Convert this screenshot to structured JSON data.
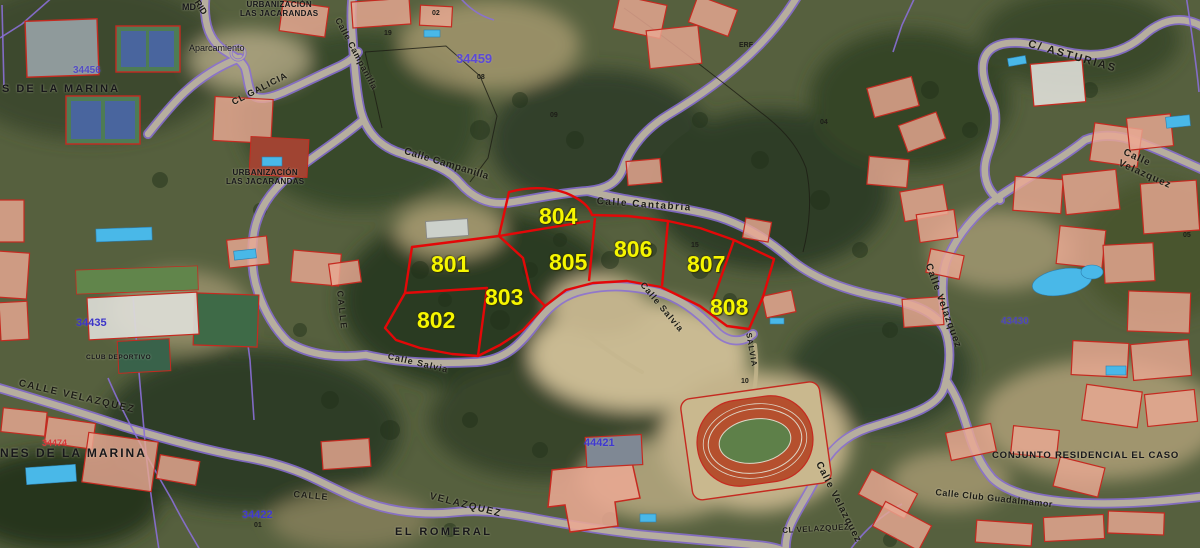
{
  "map": {
    "parcel_overlay": {
      "boundary_color": "#e30808",
      "label_color": "#f6f600",
      "plots": [
        {
          "number": "801"
        },
        {
          "number": "802"
        },
        {
          "number": "803"
        },
        {
          "number": "804"
        },
        {
          "number": "805"
        },
        {
          "number": "806"
        },
        {
          "number": "807"
        },
        {
          "number": "808"
        }
      ]
    },
    "zone_labels": [
      {
        "number": "34459",
        "color": "#5b49d6"
      },
      {
        "number": "34456",
        "color": "#4a40cc"
      },
      {
        "number": "34435",
        "color": "#3c34c8"
      },
      {
        "number": "34422",
        "color": "#3f38d0"
      },
      {
        "number": "44421",
        "color": "#3f38d0"
      },
      {
        "number": "43430",
        "color": "#4a40cc"
      },
      {
        "number": "34474",
        "color": "#d83838"
      }
    ],
    "street_labels": [
      {
        "text": "C/ ASTURIAS"
      },
      {
        "text": "Calle Velazquez"
      },
      {
        "text": "Calle Velazquez"
      },
      {
        "text": "Calle Velazquez"
      },
      {
        "text": "CL VELAZQUEZ"
      },
      {
        "text": "CALLE VELAZQUEZ"
      },
      {
        "text": "VELAZQUEZ"
      },
      {
        "text": "CL GALICIA"
      },
      {
        "text": "Calle Campanilla"
      },
      {
        "text": "Calle Campanilla"
      },
      {
        "text": "Calle Cantabria"
      },
      {
        "text": "Calle Salvia"
      },
      {
        "text": "Calle Salvia"
      },
      {
        "text": "SALVIA"
      },
      {
        "text": "CALLE"
      },
      {
        "text": "CALLE"
      },
      {
        "text": "RID"
      },
      {
        "text": "Calle Club Guadalmamor"
      }
    ],
    "place_labels": [
      {
        "text": "URBANIZACIÓN\nLAS JACARANDAS"
      },
      {
        "text": "URBANIZACIÓN\nLAS JACARANDAS"
      },
      {
        "text": "S DE LA MARINA"
      },
      {
        "text": "NES DE LA MARINA"
      },
      {
        "text": "EL ROMERAL"
      },
      {
        "text": "CONJUNTO RESIDENCIAL EL CASO"
      },
      {
        "text": "Aparcamiento"
      },
      {
        "text": "MD"
      },
      {
        "text": "CLUB DEPORTIVO"
      }
    ],
    "lot_numbers": [
      {
        "text": "02"
      },
      {
        "text": "19"
      },
      {
        "text": "08"
      },
      {
        "text": "09"
      },
      {
        "text": "04"
      },
      {
        "text": "05"
      },
      {
        "text": "15"
      },
      {
        "text": "01"
      },
      {
        "text": "10"
      },
      {
        "text": "ERF"
      }
    ]
  }
}
